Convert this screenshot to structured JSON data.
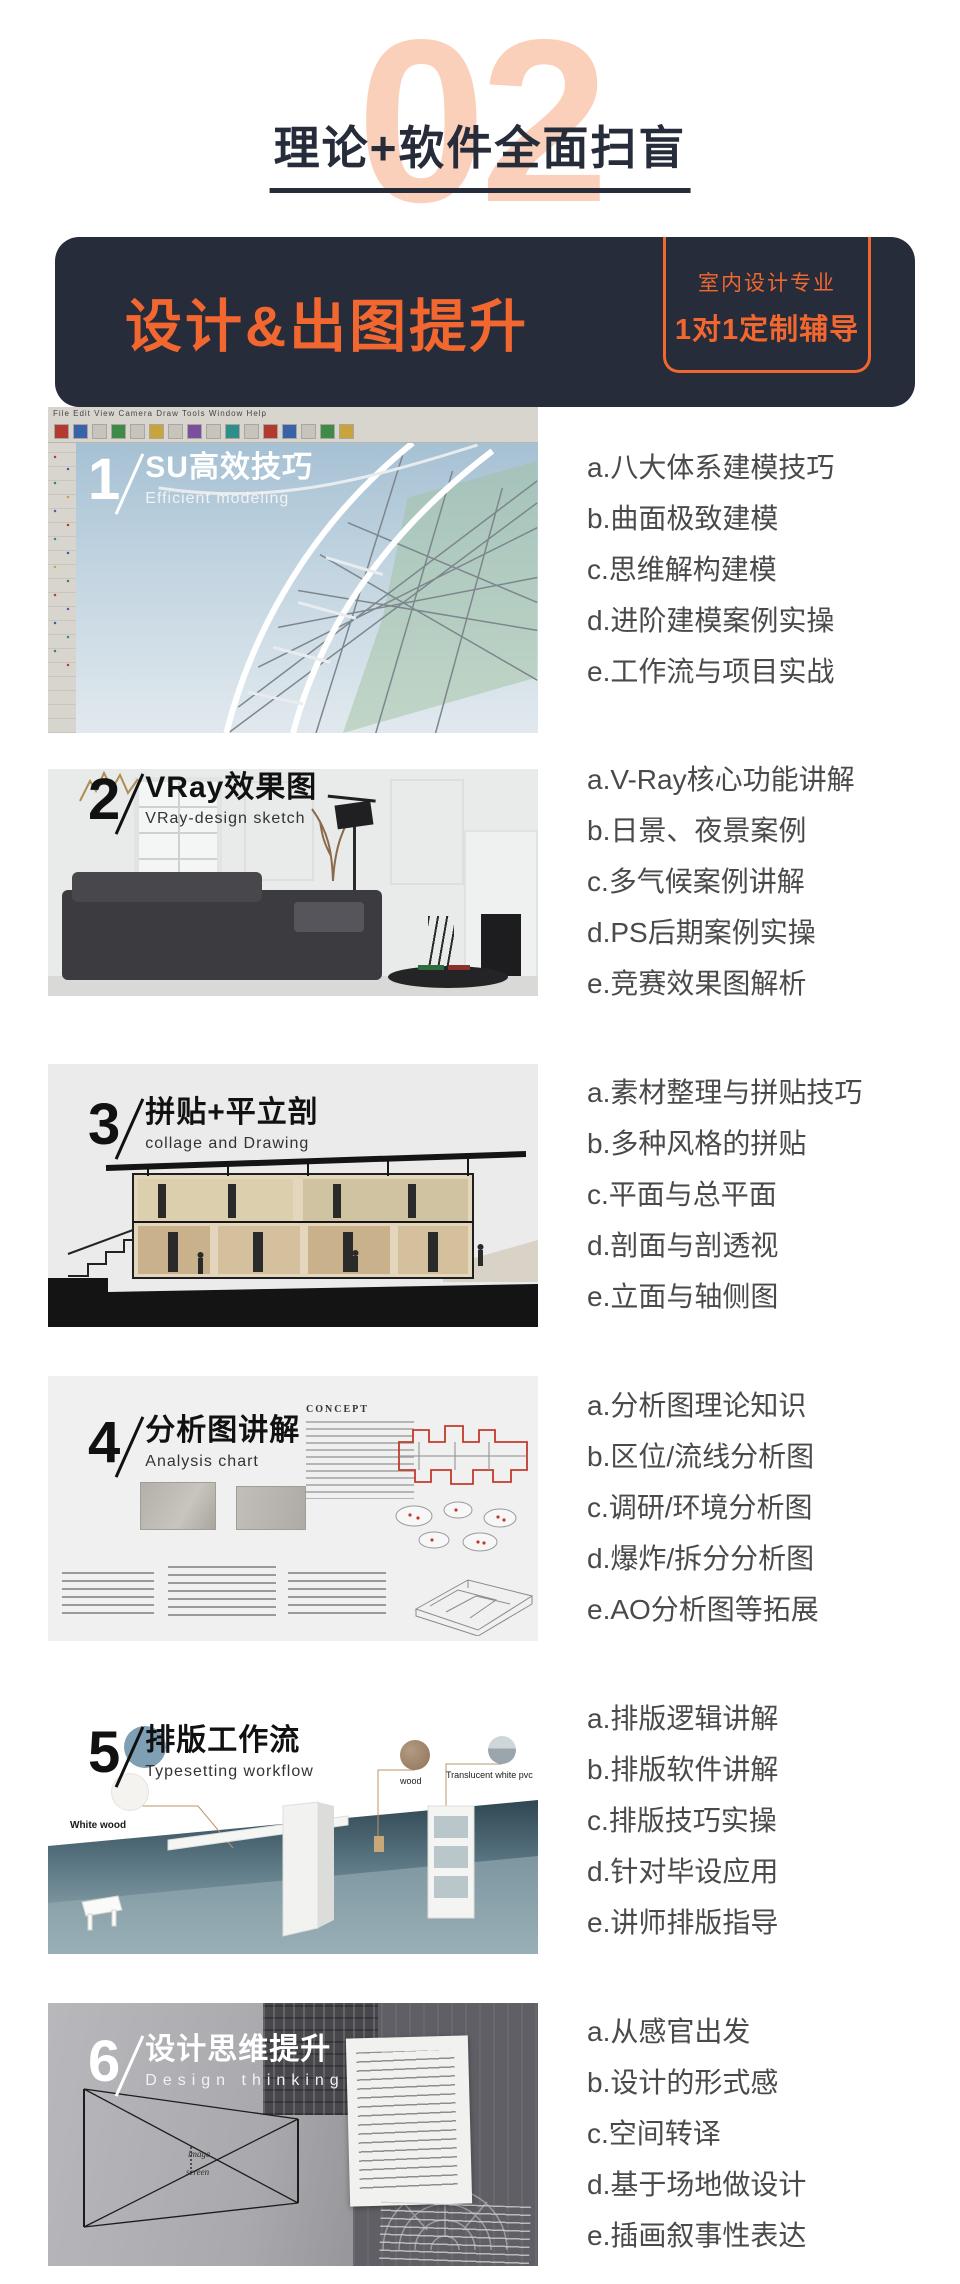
{
  "hero": {
    "big_number": "02",
    "title": "理论+软件全面扫盲"
  },
  "banner": {
    "title": "设计&出图提升",
    "badge_line1": "室内设计专业",
    "badge_line2": "1对1定制辅导"
  },
  "colors": {
    "accent_orange": "#f2672f",
    "dark_navy": "#272c3a",
    "peach_number": "#fbd0ba",
    "list_text": "#4a4a4a"
  },
  "sections": [
    {
      "number": "1",
      "title": "SU高效技巧",
      "subtitle": "Efficient modeling",
      "menu_text": "File  Edit  View  Camera  Draw  Tools  Window  Help",
      "items": [
        "a.八大体系建模技巧",
        "b.曲面极致建模",
        "c.思维解构建模",
        "d.进阶建模案例实操",
        "e.工作流与项目实战"
      ]
    },
    {
      "number": "2",
      "title": "VRay效果图",
      "subtitle": "VRay-design sketch",
      "items": [
        "a.V-Ray核心功能讲解",
        "b.日景、夜景案例",
        "c.多气候案例讲解",
        "d.PS后期案例实操",
        "e.竞赛效果图解析"
      ]
    },
    {
      "number": "3",
      "title": "拼贴+平立剖",
      "subtitle": "collage and Drawing",
      "items": [
        "a.素材整理与拼贴技巧",
        "b.多种风格的拼贴",
        "c.平面与总平面",
        "d.剖面与剖透视",
        "e.立面与轴侧图"
      ]
    },
    {
      "number": "4",
      "title": "分析图讲解",
      "subtitle": "Analysis chart",
      "concept_label": "CONCEPT",
      "items": [
        "a.分析图理论知识",
        "b.区位/流线分析图",
        "c.调研/环境分析图",
        "d.爆炸/拆分分析图",
        "e.AO分析图等拓展"
      ]
    },
    {
      "number": "5",
      "title": "排版工作流",
      "subtitle": "Typesetting workflow",
      "labels": {
        "white_wood": "White wood",
        "wood": "wood",
        "pvc": "Translucent white pvc"
      },
      "items": [
        "a.排版逻辑讲解",
        "b.排版软件讲解",
        "c.排版技巧实操",
        "d.针对毕设应用",
        "e.讲师排版指导"
      ]
    },
    {
      "number": "6",
      "title": "设计思维提升",
      "subtitle": "Design thinking",
      "labels": {
        "image_word": "image",
        "screen_word": "screen"
      },
      "items": [
        "a.从感官出发",
        "b.设计的形式感",
        "c.空间转译",
        "d.基于场地做设计",
        "e.插画叙事性表达"
      ]
    }
  ]
}
